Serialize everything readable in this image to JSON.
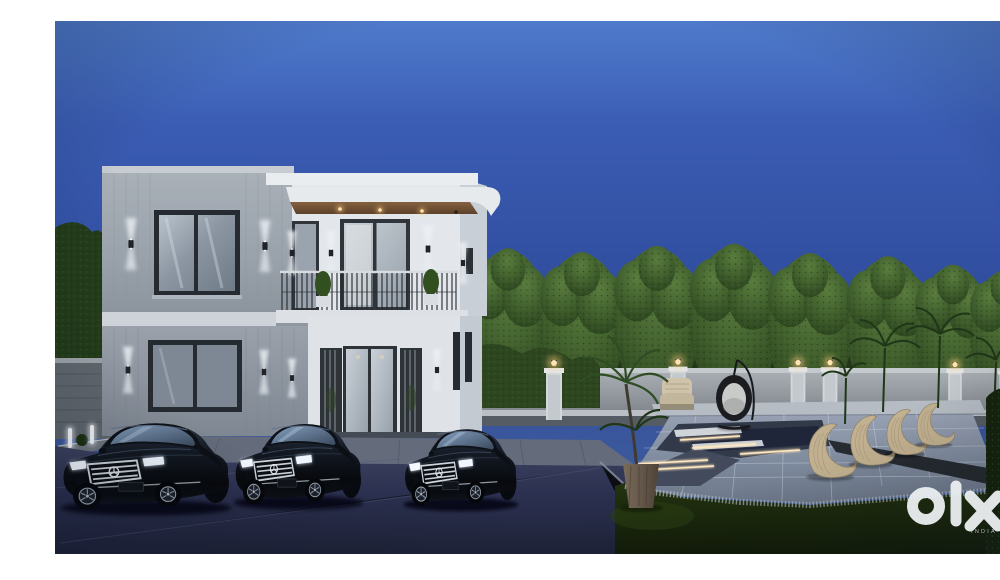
{
  "image": {
    "title": "Modern duplex villa exterior 3D render at dusk",
    "description": "Night-time architectural visualization of a two-storey modern villa with three black luxury sedans parked on the driveway, a landscaped garden with a row of trimmed trees behind a lamp-post boundary wall, and a sunken lounge deck with designer chairs and LED strip lighting.",
    "time_of_day": "dusk"
  },
  "watermark": {
    "brand": "olx",
    "country_label": "INDIA",
    "color": "#eceff1"
  },
  "palette": {
    "sky_top": "#4f7bcc",
    "sky_mid": "#2f4b9b",
    "sky_horizon": "#4a67a2",
    "facade_gray": "#9aa2ab",
    "facade_white": "#e3e7eb",
    "soffit_wood": "#7a5a3c",
    "tree_green": "#3c5a2a",
    "grass_green": "#1b2a0e",
    "driveway_navy": "#2b3050",
    "deck_gray": "#8d97a9",
    "warm_light": "#ffd9a0",
    "car_black": "#0b0e14"
  },
  "scene": {
    "objects": [
      "two-storey modern villa",
      "flat roof with wooden soffit and downlights",
      "balcony with metal railing and potted shrubs",
      "up-down wall sconces",
      "frosted glass entrance doors",
      "three black luxury sedans",
      "paved stone forecourt",
      "dark driveway",
      "stone boundary wall with lamp pillars",
      "row of trimmed ornamental trees",
      "palm plants and potted palm",
      "sunken lounge pit with LED strip lighting",
      "curved slatted loungers",
      "hanging egg chair",
      "wicker armchair",
      "garden bollard lights",
      "lawn"
    ]
  }
}
